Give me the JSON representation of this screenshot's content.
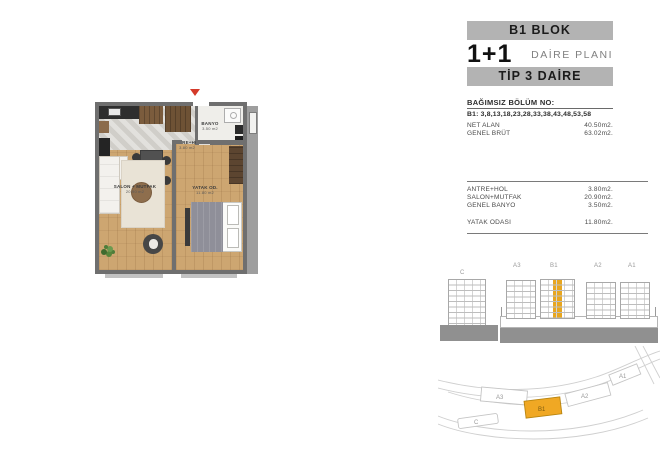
{
  "panel": {
    "block_title": "B1 BLOK",
    "unit_type": "1+1",
    "unit_type_suffix": "DAİRE PLANI",
    "tip_title": "TİP 3 DAİRE",
    "section_header": "BAĞIMSIZ BÖLÜM NO:",
    "section_numbers": "B1: 3,8,13,18,23,28,33,38,43,48,53,58",
    "areas": [
      {
        "label": "NET ALAN",
        "value": "40.50m2."
      },
      {
        "label": "GENEL BRÜT",
        "value": "63.02m2."
      }
    ],
    "rooms_group1": [
      {
        "label": "ANTRE+HOL",
        "value": "3.80m2."
      },
      {
        "label": "SALON+MUTFAK",
        "value": "20.90m2."
      },
      {
        "label": "GENEL BANYO",
        "value": "3.50m2."
      }
    ],
    "rooms_group2": [
      {
        "label": "YATAK ODASI",
        "value": "11.80m2."
      }
    ]
  },
  "floorplan": {
    "rooms": {
      "hall": {
        "name": "ANTRE+HOL",
        "area": "3.80 m2"
      },
      "bathroom": {
        "name": "BANYO",
        "area": "3.50 m2"
      },
      "living": {
        "name": "SALON + MUTFAK",
        "area": "20.90 m2"
      },
      "bedroom": {
        "name": "YATAK OD.",
        "area": "11.80 m2"
      }
    }
  },
  "elevation": {
    "side_building_label": "C",
    "building_labels": [
      "A3",
      "B1",
      "A2",
      "A1"
    ],
    "highlighted_building": "B1",
    "highlight_color": "#E8A61F"
  },
  "siteplan": {
    "labels": {
      "a3": "A3",
      "b1": "B1",
      "a2": "A2",
      "a1": "A1",
      "c": "C"
    },
    "highlight_color": "#F0A824"
  },
  "colors": {
    "bar_bg": "#B3B3B3",
    "wall": "#6F6F6F",
    "wood_floor": "#CDA671",
    "tile_floor": "#D7D5D0",
    "highlight_orange": "#E8A61F",
    "entrance_arrow": "#D43A2A"
  }
}
